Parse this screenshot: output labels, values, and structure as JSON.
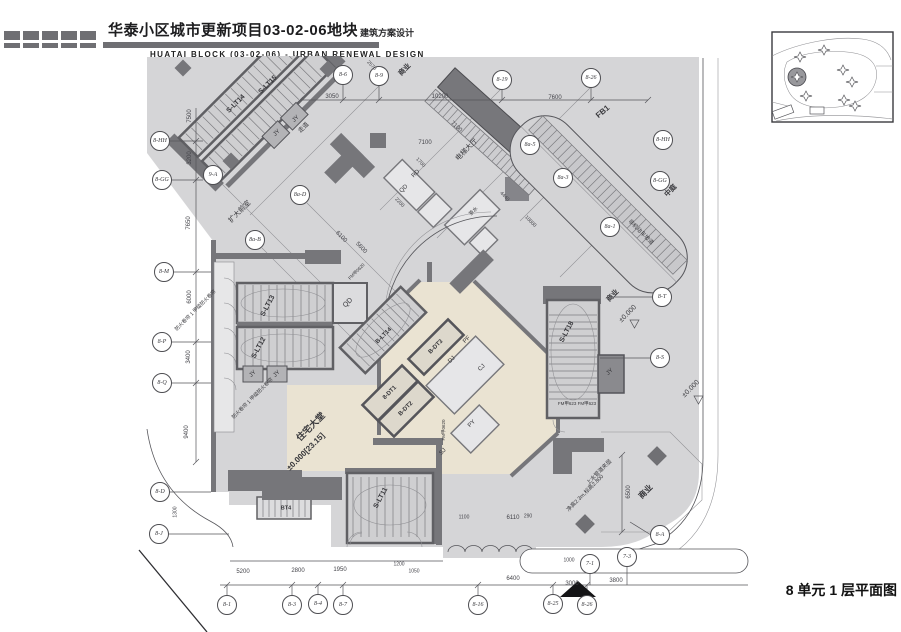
{
  "header": {
    "title_cn": "华泰小区城市更新项目03-02-06地块",
    "subtitle_cn": "建筑方案设计",
    "title_en": "HUATAI BLOCK (03-02-06) - URBAN RENEWAL DESIGN"
  },
  "footer": {
    "drawing_title": "8 单元 1 层平面图"
  },
  "colors": {
    "plan_bg": "#d5d5d7",
    "wall": "#76767a",
    "stair_fill": "#cfcfd1",
    "lobby": "#eae3d2",
    "header_bar": "#6f6f73",
    "line": "#4a4a4e"
  },
  "plan": {
    "bubbles": [
      {
        "t": "8-6",
        "x": 343,
        "y": 75
      },
      {
        "t": "8-9",
        "x": 379,
        "y": 76
      },
      {
        "t": "8-19",
        "x": 502,
        "y": 80
      },
      {
        "t": "8-26",
        "x": 591,
        "y": 78
      },
      {
        "t": "8-HH",
        "x": 160,
        "y": 141
      },
      {
        "t": "8-GG",
        "x": 162,
        "y": 180
      },
      {
        "t": "9-A",
        "x": 213,
        "y": 175
      },
      {
        "t": "8a-D",
        "x": 300,
        "y": 195
      },
      {
        "t": "8a-B",
        "x": 255,
        "y": 240
      },
      {
        "t": "8a-5",
        "x": 530,
        "y": 145
      },
      {
        "t": "8a-3",
        "x": 563,
        "y": 178
      },
      {
        "t": "8a-1",
        "x": 610,
        "y": 227
      },
      {
        "t": "8-HH",
        "x": 663,
        "y": 140
      },
      {
        "t": "8-GG",
        "x": 660,
        "y": 181
      },
      {
        "t": "8-M",
        "x": 164,
        "y": 272
      },
      {
        "t": "8-P",
        "x": 162,
        "y": 342
      },
      {
        "t": "8-Q",
        "x": 162,
        "y": 383
      },
      {
        "t": "8-D",
        "x": 160,
        "y": 492
      },
      {
        "t": "8-J",
        "x": 159,
        "y": 534
      },
      {
        "t": "8-1",
        "x": 227,
        "y": 605
      },
      {
        "t": "8-3",
        "x": 292,
        "y": 605
      },
      {
        "t": "8-4",
        "x": 318,
        "y": 604
      },
      {
        "t": "8-7",
        "x": 343,
        "y": 605
      },
      {
        "t": "8-16",
        "x": 478,
        "y": 605
      },
      {
        "t": "8-25",
        "x": 553,
        "y": 604
      },
      {
        "t": "8-26",
        "x": 587,
        "y": 605
      },
      {
        "t": "7-1",
        "x": 590,
        "y": 564
      },
      {
        "t": "7-3",
        "x": 627,
        "y": 557
      },
      {
        "t": "8-A",
        "x": 660,
        "y": 535
      },
      {
        "t": "8-S",
        "x": 660,
        "y": 358
      },
      {
        "t": "8-T",
        "x": 662,
        "y": 297
      }
    ],
    "dims": [
      {
        "t": "3050",
        "x": 332,
        "y": 97
      },
      {
        "t": "10200",
        "x": 440,
        "y": 97
      },
      {
        "t": "7600",
        "x": 555,
        "y": 98
      },
      {
        "t": "2570",
        "x": 371,
        "y": 66,
        "r": 45,
        "s": 5
      },
      {
        "t": "7100",
        "x": 425,
        "y": 143
      },
      {
        "t": "7100",
        "x": 456,
        "y": 127,
        "r": 42
      },
      {
        "t": "7500",
        "x": 190,
        "y": 116,
        "r": -90
      },
      {
        "t": "3200",
        "x": 190,
        "y": 158,
        "r": -90
      },
      {
        "t": "7650",
        "x": 189,
        "y": 223,
        "r": -90
      },
      {
        "t": "6000",
        "x": 190,
        "y": 297,
        "r": -90
      },
      {
        "t": "3400",
        "x": 189,
        "y": 357,
        "r": -90
      },
      {
        "t": "9400",
        "x": 187,
        "y": 432,
        "r": -90
      },
      {
        "t": "1300",
        "x": 176,
        "y": 512,
        "r": -90,
        "s": 5
      },
      {
        "t": "5200",
        "x": 243,
        "y": 572
      },
      {
        "t": "2800",
        "x": 298,
        "y": 571
      },
      {
        "t": "1950",
        "x": 340,
        "y": 570
      },
      {
        "t": "1200",
        "x": 399,
        "y": 565,
        "s": 5
      },
      {
        "t": "1050",
        "x": 414,
        "y": 572,
        "s": 5
      },
      {
        "t": "6400",
        "x": 513,
        "y": 579
      },
      {
        "t": "3000",
        "x": 572,
        "y": 584
      },
      {
        "t": "1000",
        "x": 569,
        "y": 561,
        "s": 5
      },
      {
        "t": "3800",
        "x": 616,
        "y": 581
      },
      {
        "t": "6110",
        "x": 513,
        "y": 518
      },
      {
        "t": "1100",
        "x": 464,
        "y": 518,
        "s": 5
      },
      {
        "t": "290",
        "x": 528,
        "y": 517,
        "s": 5
      },
      {
        "t": "6500",
        "x": 629,
        "y": 492,
        "r": -90
      },
      {
        "t": "6100",
        "x": 341,
        "y": 237,
        "r": 45
      },
      {
        "t": "5600",
        "x": 361,
        "y": 248,
        "r": 45
      },
      {
        "t": "4440",
        "x": 504,
        "y": 197,
        "r": 45,
        "s": 5
      },
      {
        "t": "10000",
        "x": 530,
        "y": 222,
        "r": 45,
        "s": 5
      },
      {
        "t": "2200",
        "x": 399,
        "y": 203,
        "r": 45,
        "s": 5
      },
      {
        "t": "1700",
        "x": 420,
        "y": 163,
        "r": 45,
        "s": 5
      }
    ],
    "labels": [
      {
        "t": "商业",
        "x": 405,
        "y": 70,
        "r": -45,
        "s": 7,
        "w": 700
      },
      {
        "t": "商业",
        "x": 613,
        "y": 296,
        "r": -45,
        "s": 7,
        "w": 700
      },
      {
        "t": "商业",
        "x": 646,
        "y": 492,
        "r": -45,
        "s": 8,
        "w": 700
      },
      {
        "t": "中庭",
        "x": 671,
        "y": 191,
        "r": -45,
        "s": 7,
        "w": 700
      },
      {
        "t": "FB1",
        "x": 603,
        "y": 112,
        "r": -40,
        "s": 8,
        "w": 700
      },
      {
        "t": "电梯大厅",
        "x": 467,
        "y": 150,
        "r": -45,
        "s": 7
      },
      {
        "t": "走道",
        "x": 304,
        "y": 128,
        "r": -45,
        "s": 6
      },
      {
        "t": "扩大前室",
        "x": 240,
        "y": 212,
        "r": -45,
        "s": 7
      },
      {
        "t": "住宅大堂",
        "x": 311,
        "y": 427,
        "r": -45,
        "s": 9,
        "w": 700
      },
      {
        "t": "±0.000[23.15]",
        "x": 306,
        "y": 452,
        "r": -45,
        "s": 8,
        "w": 700
      },
      {
        "t": "±0.000",
        "x": 628,
        "y": 314,
        "r": -45,
        "s": 7
      },
      {
        "t": "±0.000",
        "x": 691,
        "y": 389,
        "r": -45,
        "s": 7
      },
      {
        "t": "S-LT14",
        "x": 236,
        "y": 104,
        "r": -45,
        "s": 7,
        "w": 700
      },
      {
        "t": "S-LT15",
        "x": 268,
        "y": 85,
        "r": -45,
        "s": 7,
        "w": 700
      },
      {
        "t": "S-LT13",
        "x": 268,
        "y": 306,
        "r": -62,
        "s": 7,
        "w": 700
      },
      {
        "t": "S-LT12",
        "x": 259,
        "y": 348,
        "r": -62,
        "s": 7,
        "w": 700
      },
      {
        "t": "S-LT18",
        "x": 567,
        "y": 332,
        "r": -62,
        "s": 7,
        "w": 700
      },
      {
        "t": "S-LT11",
        "x": 381,
        "y": 498,
        "r": -62,
        "s": 7,
        "w": 700
      },
      {
        "t": "B-LT14",
        "x": 384,
        "y": 336,
        "r": -45,
        "s": 6,
        "w": 700
      },
      {
        "t": "8-DT1",
        "x": 390,
        "y": 393,
        "r": -45,
        "s": 6,
        "w": 700
      },
      {
        "t": "B-DT2",
        "x": 406,
        "y": 409,
        "r": -45,
        "s": 6,
        "w": 700
      },
      {
        "t": "B-DT3",
        "x": 436,
        "y": 347,
        "r": -45,
        "s": 6,
        "w": 700
      },
      {
        "t": "BT4",
        "x": 286,
        "y": 509,
        "s": 5.5,
        "w": 700
      },
      {
        "t": "QD",
        "x": 348,
        "y": 303,
        "r": -45,
        "s": 7
      },
      {
        "t": "QD",
        "x": 404,
        "y": 189,
        "r": -45,
        "s": 6
      },
      {
        "t": "RD",
        "x": 416,
        "y": 174,
        "r": -45,
        "s": 6
      },
      {
        "t": "JY",
        "x": 277,
        "y": 133,
        "r": -45,
        "s": 6
      },
      {
        "t": "JY",
        "x": 296,
        "y": 119,
        "r": -45,
        "s": 6
      },
      {
        "t": "JY",
        "x": 253,
        "y": 374,
        "r": -45,
        "s": 6
      },
      {
        "t": "JY",
        "x": 277,
        "y": 374,
        "r": -45,
        "s": 6
      },
      {
        "t": "JY",
        "x": 610,
        "y": 372,
        "r": -45,
        "s": 6
      },
      {
        "t": "DJ",
        "x": 452,
        "y": 360,
        "r": -45,
        "s": 6
      },
      {
        "t": "CJ",
        "x": 482,
        "y": 368,
        "r": -45,
        "s": 6
      },
      {
        "t": "PF",
        "x": 467,
        "y": 340,
        "r": -45,
        "s": 6
      },
      {
        "t": "PY",
        "x": 472,
        "y": 424,
        "r": -45,
        "s": 6
      },
      {
        "t": "SJ",
        "x": 443,
        "y": 452,
        "r": -45,
        "s": 6
      },
      {
        "t": "茶水",
        "x": 474,
        "y": 212,
        "r": -45,
        "s": 5
      },
      {
        "t": "上水管道夹层",
        "x": 600,
        "y": 473,
        "r": -45,
        "s": 5.5
      },
      {
        "t": "净高2.3m,标高2.800",
        "x": 586,
        "y": 494,
        "r": -45,
        "s": 5.5
      },
      {
        "t": "非机动车坡道",
        "x": 640,
        "y": 233,
        "r": 45,
        "s": 5.5
      },
      {
        "t": "FM甲623 FM甲623",
        "x": 577,
        "y": 404,
        "s": 4.5
      },
      {
        "t": "FM甲0620",
        "x": 357,
        "y": 272,
        "r": -45,
        "s": 4.5
      },
      {
        "t": "FM甲0620",
        "x": 444,
        "y": 430,
        "r": -90,
        "s": 4.5
      },
      {
        "t": "防火卷帘 1 甲级防火卷帘",
        "x": 196,
        "y": 311,
        "r": -45,
        "s": 5
      },
      {
        "t": "防火卷帘 1 甲级防火卷帘",
        "x": 253,
        "y": 399,
        "r": -45,
        "s": 5
      }
    ]
  }
}
